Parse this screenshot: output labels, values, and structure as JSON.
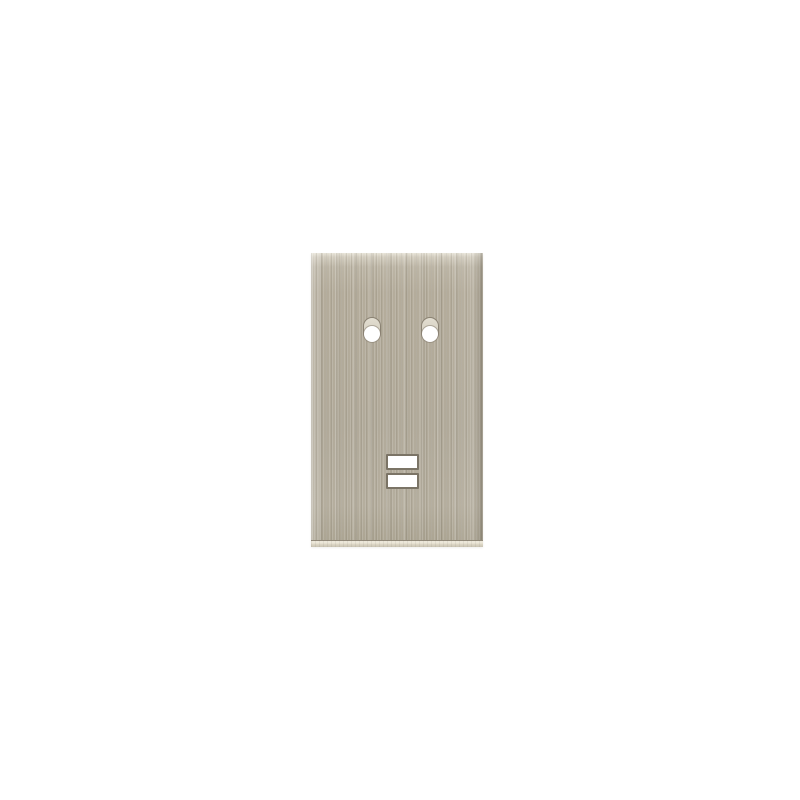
{
  "photo": {
    "subject": "Vertical rectangular brushed-metal wall plate on a plain white background",
    "finish": "brushed nickel",
    "mounting_hole_count": 2,
    "slot_count": 2
  },
  "colors": {
    "background": "#ffffff",
    "plate_base": "#b4ac9b",
    "plate_top_sheen": "#e8e4d8",
    "plate_bevel_light": "#ece7d9",
    "plate_bevel_dark": "#c9c3b2",
    "hole_ring": "#8a8273",
    "hole_recess": "#d9d4c6",
    "hole_opening": "#ffffff",
    "slot_border": "#7b7466",
    "slot_fill": "#ffffff"
  }
}
